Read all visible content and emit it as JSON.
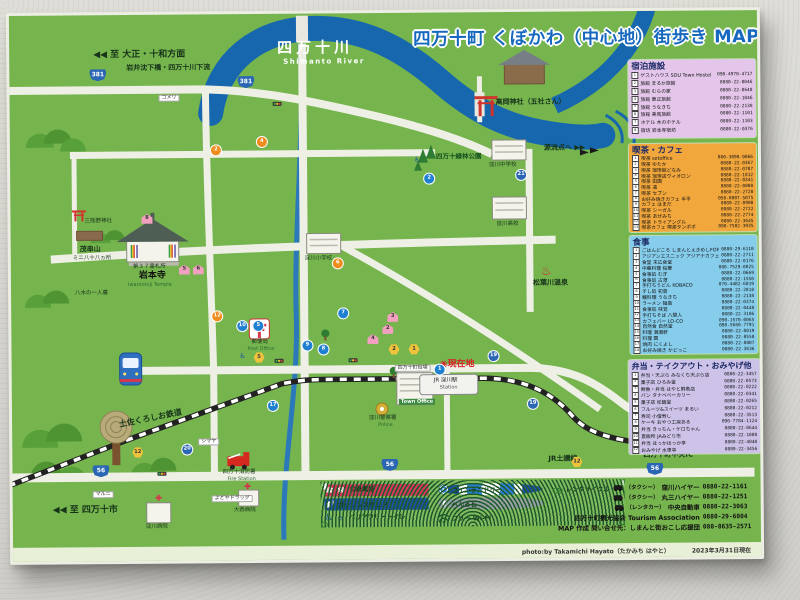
{
  "title": "四万十町 くぼかわ（中心地）街歩き MAP",
  "colors": {
    "sign_green": "#76b44e",
    "river_blue": "#1767ae",
    "title_blue": "#1769c0",
    "panel_lodging_bg": "#e3c6ea",
    "panel_cafe_bg": "#f2a73d",
    "panel_food_bg": "#86cdec",
    "panel_bento_bg": "#cdc2e8"
  },
  "panels": {
    "lodging": {
      "title": "宿泊施設",
      "entries": [
        {
          "no": "1",
          "name": "ゲストハウス SOU Town Hostel",
          "phone": "090-4970-4717"
        },
        {
          "no": "2",
          "name": "旅館 まるか旅館",
          "phone": "0880-22-0046"
        },
        {
          "no": "3",
          "name": "旅館 むらの家",
          "phone": "0880-22-0648"
        },
        {
          "no": "4",
          "name": "旅館 東正旅館",
          "phone": "0880-22-1046"
        },
        {
          "no": "5",
          "name": "旅館 うなきち",
          "phone": "0880-22-2138"
        },
        {
          "no": "6",
          "name": "旅館 美馬旅館",
          "phone": "0880-22-1101"
        },
        {
          "no": "7",
          "name": "ホテル 木のホテル",
          "phone": "0880-22-1103"
        },
        {
          "no": "8",
          "name": "宿坊 岩本寺宿坊",
          "phone": "0880-22-0376"
        }
      ]
    },
    "cafe": {
      "title": "喫茶・カフェ",
      "entries": [
        {
          "no": "1",
          "name": "喫茶 sotoffice",
          "phone": "080-3098-9066"
        },
        {
          "no": "2",
          "name": "喫茶 ゆたか",
          "phone": "0880-22-0367"
        },
        {
          "no": "3",
          "name": "喫茶 珈琲館どなみ",
          "phone": "0880-22-0707"
        },
        {
          "no": "4",
          "name": "喫茶 珈琲店ヴィオロン",
          "phone": "0880-22-1812"
        },
        {
          "no": "5",
          "name": "喫茶 田園",
          "phone": "0880-22-0341"
        },
        {
          "no": "6",
          "name": "喫茶 凛",
          "phone": "0880-22-0080"
        },
        {
          "no": "7",
          "name": "喫茶 セブン",
          "phone": "0880-22-2728"
        },
        {
          "no": "8",
          "name": "お好み焼きカフェ 半平",
          "phone": "050-8807-5075"
        },
        {
          "no": "9",
          "name": "カフェ はまだ",
          "phone": "0880-22-0980"
        },
        {
          "no": "10",
          "name": "喫茶 シーガル",
          "phone": "0880-22-2722"
        },
        {
          "no": "11",
          "name": "喫茶 あぜみち",
          "phone": "0880-22-2774"
        },
        {
          "no": "12",
          "name": "喫茶 トライアングル",
          "phone": "0880-22-3645"
        },
        {
          "no": "13",
          "name": "喫茶カフェ 喫茶タンポポ",
          "phone": "090-7582-3935"
        }
      ]
    },
    "food": {
      "title": "食事",
      "entries": [
        {
          "no": "1",
          "name": "ごはんどころ しまんとえきめしFORM",
          "phone": "0880-29-6110"
        },
        {
          "no": "2",
          "name": "アジアンエスニック アジアナカフェ",
          "phone": "0880-22-2711"
        },
        {
          "no": "3",
          "name": "食堂 末広食堂",
          "phone": "0880-22-0176"
        },
        {
          "no": "4",
          "name": "中華料理 桜華",
          "phone": "080-7529-8025"
        },
        {
          "no": "5",
          "name": "食事処 むぎ",
          "phone": "0880-22-0669"
        },
        {
          "no": "6",
          "name": "食事処 古潭",
          "phone": "0880-22-1550"
        },
        {
          "no": "7",
          "name": "手打ちうどん KOBACO",
          "phone": "070-4482-6019"
        },
        {
          "no": "8",
          "name": "すし処 初音",
          "phone": "0880-22-2810"
        },
        {
          "no": "9",
          "name": "鰻料理 うなきち",
          "phone": "0880-22-2138"
        },
        {
          "no": "10",
          "name": "ラーメン 麺島",
          "phone": "0880-22-0374"
        },
        {
          "no": "11",
          "name": "食事処 味覚",
          "phone": "0880-22-0448"
        },
        {
          "no": "12",
          "name": "手打ちそば 八間人",
          "phone": "0880-22-3186"
        },
        {
          "no": "13",
          "name": "カフェバー LO-CO",
          "phone": "090-1570-0065"
        },
        {
          "no": "14",
          "name": "自然食 自然堂",
          "phone": "080-5660-7791"
        },
        {
          "no": "15",
          "name": "料理 満潮軒",
          "phone": "0880-22-0019"
        },
        {
          "no": "16",
          "name": "料理 園",
          "phone": "0880-22-0558"
        },
        {
          "no": "17",
          "name": "焼肉 にくよし",
          "phone": "0880-22-0807"
        },
        {
          "no": "18",
          "name": "お好み焼き かどっこ",
          "phone": "0880-22-3636"
        }
      ]
    },
    "bento": {
      "title": "弁当・テイクアウト・おみやげ他",
      "entries": [
        {
          "no": "1",
          "name": "弁当・天ぷら みなくち天ぷら店",
          "phone": "0880-22-3457"
        },
        {
          "no": "2",
          "name": "菓子店 ひろみ堂",
          "phone": "0880-22-0573"
        },
        {
          "no": "3",
          "name": "鮮魚・弁当 はやと鮮魚店",
          "phone": "0880-22-0222"
        },
        {
          "no": "4",
          "name": "パン タナベベーカリー",
          "phone": "0880-22-0341"
        },
        {
          "no": "5",
          "name": "菓子店 松鶴堂",
          "phone": "0880-22-0265"
        },
        {
          "no": "6",
          "name": "フルーツ&スイーツ まるい",
          "phone": "0880-22-0212"
        },
        {
          "no": "7",
          "name": "寿司 小僧寿し",
          "phone": "0880-22-3513"
        },
        {
          "no": "8",
          "name": "ケーキ おやつ工房ある",
          "phone": "090-7784-1124"
        },
        {
          "no": "9",
          "name": "弁当 きっちん・ケロちゃん",
          "phone": "0880-22-0644"
        },
        {
          "no": "10",
          "name": "直販所 JAみどり市",
          "phone": "0880-22-1008"
        },
        {
          "no": "11",
          "name": "弁当 ほっかほっか亭",
          "phone": "0880-22-4040"
        },
        {
          "no": "12",
          "name": "おみやげ 水車亭",
          "phone": "0880-22-3456"
        }
      ]
    }
  },
  "map": {
    "labels": [
      {
        "text": "◀◀ 至 大正・十和方面",
        "x": 84,
        "y": 36,
        "cls": "l-dk l-b l-big"
      },
      {
        "text": "岩井沈下橋・四万十川下流",
        "x": 117,
        "y": 50,
        "cls": "l-dk l-b"
      },
      {
        "text": "四万十川",
        "x": 268,
        "y": 27,
        "cls": "l-riv"
      },
      {
        "text": "Shimanto River",
        "x": 274,
        "y": 45,
        "cls": "l-riv-en"
      },
      {
        "text": "高岡神社（五社さん）",
        "x": 486,
        "y": 87,
        "cls": "l-dk l-b"
      },
      {
        "text": "源流点へ  ▶▶",
        "x": 534,
        "y": 133,
        "cls": "l-dk l-b"
      },
      {
        "text": "四万十緑林公園",
        "x": 426,
        "y": 141,
        "cls": "l-grn"
      },
      {
        "text": "窪川中学校",
        "x": 479,
        "y": 151,
        "cls": "l-dk-s"
      },
      {
        "text": "窪川高校",
        "x": 486,
        "y": 210,
        "cls": "l-dk-s"
      },
      {
        "text": "窪川小学校",
        "x": 294,
        "y": 243,
        "cls": "l-dk-s"
      },
      {
        "text": "三熊野神社",
        "x": 74,
        "y": 204,
        "cls": "l-dk-s"
      },
      {
        "text": "茂串山",
        "x": 69,
        "y": 231,
        "cls": "l-dk l-b"
      },
      {
        "text": "ミニ八十八ヵ所",
        "x": 62,
        "y": 241,
        "cls": "l-dk-s"
      },
      {
        "text": "八木の一人墓",
        "x": 64,
        "y": 276,
        "cls": "l-dk-s"
      },
      {
        "text": "第３７番札所",
        "x": 122,
        "y": 250,
        "cls": "l-dk-s"
      },
      {
        "text": "岩本寺",
        "x": 128,
        "y": 257,
        "cls": "l-tmpl"
      },
      {
        "text": "Iwamotoji Temple",
        "x": 117,
        "y": 268,
        "cls": "l-en-g"
      },
      {
        "text": "松葉川温泉",
        "x": 522,
        "y": 268,
        "cls": "l-dk l-b"
      },
      {
        "text": "♨",
        "x": 530,
        "y": 253,
        "cls": "l-onsen"
      },
      {
        "text": "郵便局",
        "x": 240,
        "y": 326,
        "cls": "l-dk-s"
      },
      {
        "text": "Post Office",
        "x": 236,
        "y": 333,
        "cls": "l-en-g"
      },
      {
        "text": "◉現在地",
        "x": 428,
        "y": 348,
        "cls": "l-red"
      },
      {
        "text": "JR 窪川駅",
        "x": 422,
        "y": 366,
        "cls": "l-sta"
      },
      {
        "text": "Station",
        "x": 428,
        "y": 373,
        "cls": "l-sta-en"
      },
      {
        "text": "四万十町役場",
        "x": 383,
        "y": 352,
        "cls": "l-tag"
      },
      {
        "text": "Town Office",
        "x": 387,
        "y": 386,
        "cls": "l-town"
      },
      {
        "text": "窪川警察署",
        "x": 357,
        "y": 403,
        "cls": "l-dk-s"
      },
      {
        "text": "Police",
        "x": 366,
        "y": 410,
        "cls": "l-en-g"
      },
      {
        "text": "土佐くろしお鉄道",
        "x": 107,
        "y": 406,
        "cls": "l-dk l-b l-rail"
      },
      {
        "text": "JR土讃線",
        "x": 536,
        "y": 444,
        "cls": "l-dk l-b"
      },
      {
        "text": "至 須崎市・高知市",
        "x": 623,
        "y": 428,
        "cls": "l-dk l-b"
      },
      {
        "text": "四万十町中央IC",
        "x": 631,
        "y": 441,
        "cls": "l-dk l-b"
      },
      {
        "text": "▶▶",
        "x": 712,
        "y": 432,
        "cls": "l-dk l-b l-big"
      },
      {
        "text": "◀◀ 至 四万十市",
        "x": 40,
        "y": 491,
        "cls": "l-dk l-b l-big"
      },
      {
        "text": "窪川病院",
        "x": 133,
        "y": 510,
        "cls": "l-dk-s"
      },
      {
        "text": "大西病院",
        "x": 221,
        "y": 494,
        "cls": "l-dk-s"
      },
      {
        "text": "マルニ",
        "x": 80,
        "y": 476,
        "cls": "l-tag"
      },
      {
        "text": "シマヤ",
        "x": 186,
        "y": 424,
        "cls": "l-tag"
      },
      {
        "text": "よどやドラッグ",
        "x": 199,
        "y": 481,
        "cls": "l-tag"
      },
      {
        "text": "コメリ",
        "x": 149,
        "y": 80,
        "cls": "l-tag"
      },
      {
        "text": "四万十消防署",
        "x": 210,
        "y": 456,
        "cls": "l-dk-s"
      },
      {
        "text": "Fire Station",
        "x": 215,
        "y": 463,
        "cls": "l-en-g"
      },
      {
        "text": "♿",
        "x": 404,
        "y": 144,
        "cls": "l-wc"
      },
      {
        "text": "♿",
        "x": 228,
        "y": 339,
        "cls": "l-wc"
      }
    ],
    "badges": [
      {
        "cls": "b-route",
        "n": "381",
        "x": 80,
        "y": 54
      },
      {
        "cls": "b-route",
        "n": "381",
        "x": 228,
        "y": 62
      },
      {
        "cls": "b-route",
        "n": "56",
        "x": 80,
        "y": 450
      },
      {
        "cls": "b-route",
        "n": "56",
        "x": 369,
        "y": 446
      },
      {
        "cls": "b-route",
        "n": "56",
        "x": 634,
        "y": 452
      },
      {
        "cls": "b-pref",
        "n": "19",
        "x": 477,
        "y": 339
      },
      {
        "cls": "b-pref",
        "n": "19",
        "x": 516,
        "y": 387
      },
      {
        "cls": "b-pref",
        "n": "21",
        "x": 506,
        "y": 158
      },
      {
        "cls": "b-pref",
        "n": "20",
        "x": 170,
        "y": 430
      },
      {
        "cls": "b-bento",
        "n": "12",
        "x": 120,
        "y": 432
      },
      {
        "cls": "b-bento",
        "n": "12",
        "x": 559,
        "y": 445
      },
      {
        "cls": "b-food",
        "n": "10",
        "x": 226,
        "y": 307
      },
      {
        "cls": "b-food",
        "n": "5",
        "x": 242,
        "y": 307
      },
      {
        "cls": "b-food",
        "n": "7",
        "x": 327,
        "y": 295
      },
      {
        "cls": "b-food",
        "n": "9",
        "x": 291,
        "y": 327
      },
      {
        "cls": "b-food",
        "n": "8",
        "x": 307,
        "y": 331
      },
      {
        "cls": "b-food",
        "n": "17",
        "x": 256,
        "y": 387
      },
      {
        "cls": "b-food",
        "n": "1",
        "x": 423,
        "y": 352
      },
      {
        "cls": "b-food",
        "n": "2",
        "x": 414,
        "y": 161
      },
      {
        "cls": "b-cafe",
        "n": "2",
        "x": 201,
        "y": 131
      },
      {
        "cls": "b-cafe",
        "n": "4",
        "x": 247,
        "y": 123
      },
      {
        "cls": "b-cafe",
        "n": "6",
        "x": 322,
        "y": 245
      },
      {
        "cls": "b-cafe",
        "n": "12",
        "x": 201,
        "y": 297
      },
      {
        "cls": "b-inn",
        "n": "8",
        "x": 131,
        "y": 199
      },
      {
        "cls": "b-inn",
        "n": "3",
        "x": 376,
        "y": 299
      },
      {
        "cls": "b-inn",
        "n": "2",
        "x": 371,
        "y": 311
      },
      {
        "cls": "b-inn",
        "n": "4",
        "x": 356,
        "y": 321
      },
      {
        "cls": "b-inn",
        "n": "5",
        "x": 168,
        "y": 250
      },
      {
        "cls": "b-inn",
        "n": "6",
        "x": 182,
        "y": 250
      },
      {
        "cls": "b-bento",
        "n": "2",
        "x": 377,
        "y": 331
      },
      {
        "cls": "b-bento",
        "n": "1",
        "x": 397,
        "y": 331
      },
      {
        "cls": "b-bento",
        "n": "5",
        "x": 242,
        "y": 338
      }
    ]
  },
  "legend": {
    "items": [
      {
        "label": "公衆電話",
        "cls": "ic-phone"
      },
      {
        "label": "ガソリンスタンド",
        "cls": "ic-gas"
      },
      {
        "label": "バリアフリートイレ",
        "cls": "ic-wc"
      },
      {
        "label": "コインランドリー",
        "cls": "ic-laundry"
      },
      {
        "label": "へんろ石",
        "cls": "ic-stone"
      },
      {
        "label": "フリー Wi-Fi",
        "cls": "ic-wifi"
      },
      {
        "label": "レンタサイクル",
        "cls": "ic-cycle"
      }
    ]
  },
  "info": {
    "rows": [
      {
        "pre": "（タクシー）",
        "name": "窪川ハイヤー",
        "phone": "0880-22-1161",
        "cls": "has-car"
      },
      {
        "pre": "（タクシー）",
        "name": "丸三ハイヤー",
        "phone": "0880-22-1251",
        "cls": "has-car"
      },
      {
        "pre": "（レンタカー）",
        "name": "中央自動車",
        "phone": "0880-22-3063",
        "cls": "has-car"
      },
      {
        "name": "四万十町観光協会 Tourism Association",
        "phone": "0880-29-6004"
      },
      {
        "name": "MAP 作成 問い合せ先：しまんと街おこし応援団",
        "phone": "080-8635-2571"
      }
    ]
  },
  "credit": {
    "photo": "photo:by Takamichi Hayato（たかみち はやと）",
    "date": "2023年3月31日現在"
  }
}
